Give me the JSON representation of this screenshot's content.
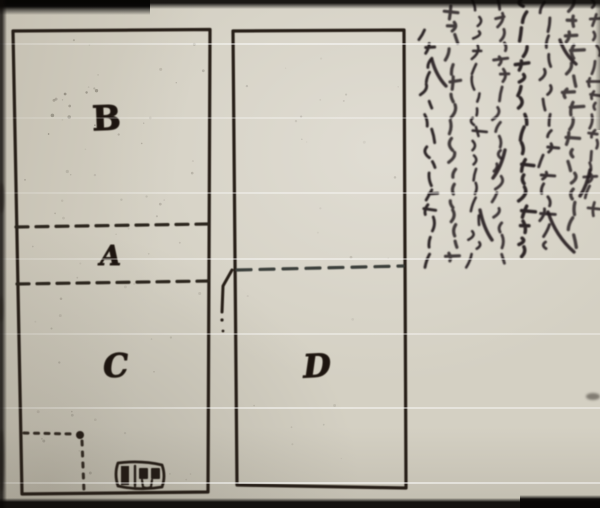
{
  "figure": {
    "labels": [
      {
        "id": "region-b",
        "label": "B"
      },
      {
        "id": "region-a",
        "label": "A"
      },
      {
        "id": "region-c",
        "label": "C"
      },
      {
        "id": "region-d",
        "label": "D"
      }
    ]
  },
  "colors": {
    "paper": "#d4d0c3",
    "ink": "#241c16",
    "handwriting_ink": "#231b1e",
    "dash_left": "#2b251d",
    "dash_right": "#3b3f3b",
    "scan_line": "#ffffff"
  }
}
